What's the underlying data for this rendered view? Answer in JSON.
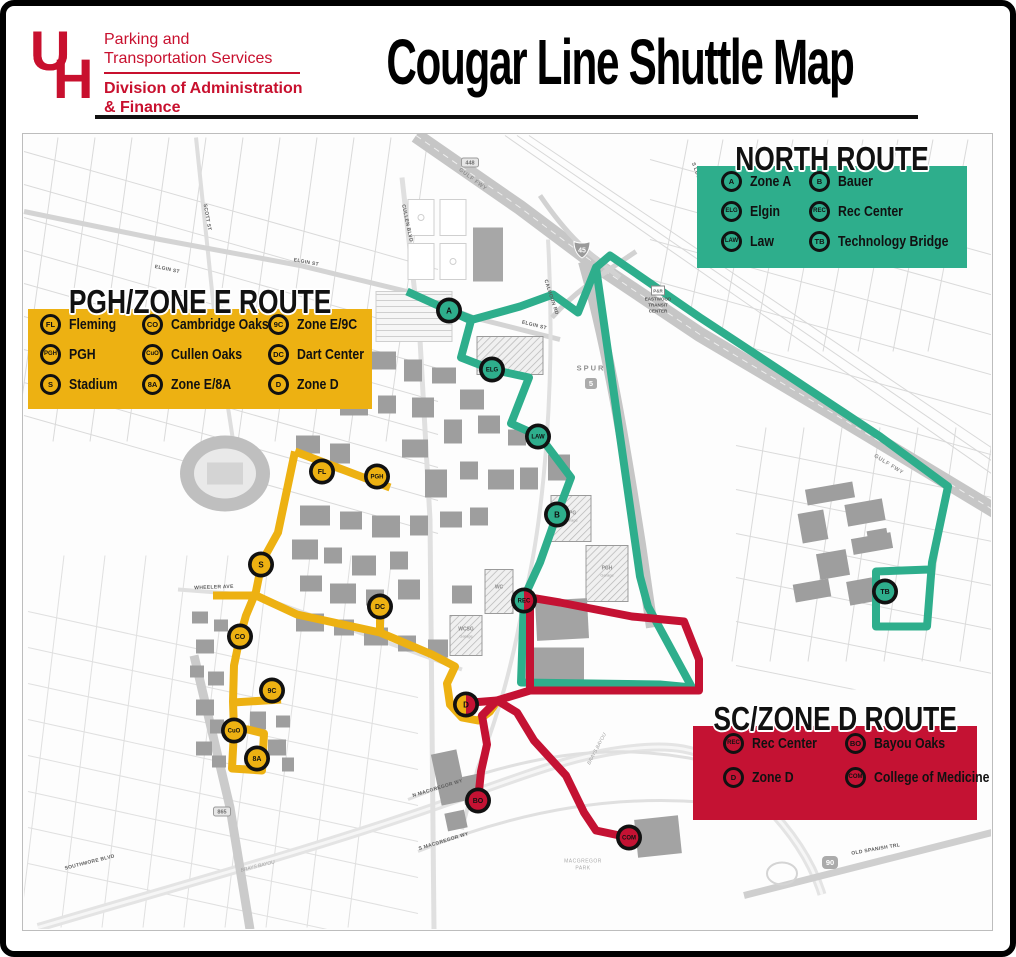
{
  "header": {
    "logo": "UH",
    "dept_line1": "Parking and",
    "dept_line2": "Transportation Services",
    "division_line1": "Division of Administration",
    "division_line2": "& Finance",
    "title": "Cougar Line Shuttle Map"
  },
  "colors": {
    "uh_red": "#C8102E",
    "north": "#2EAE8C",
    "pgh": "#EDB112",
    "sc": "#C41233",
    "badge_ring": "#111111"
  },
  "legends": [
    {
      "id": "north",
      "title": "NORTH ROUTE",
      "color": "north",
      "stops": [
        {
          "code": "A",
          "label": "Zone A"
        },
        {
          "code": "ELG",
          "label": "Elgin"
        },
        {
          "code": "LAW",
          "label": "Law"
        },
        {
          "code": "B",
          "label": "Bauer"
        },
        {
          "code": "REC",
          "label": "Rec Center"
        },
        {
          "code": "TB",
          "label": "Technology Bridge"
        }
      ]
    },
    {
      "id": "pgh",
      "title": "PGH/ZONE E ROUTE",
      "color": "pgh",
      "stops": [
        {
          "code": "FL",
          "label": "Fleming"
        },
        {
          "code": "PGH",
          "label": "PGH"
        },
        {
          "code": "S",
          "label": "Stadium"
        },
        {
          "code": "CO",
          "label": "Cambridge Oaks"
        },
        {
          "code": "CuO",
          "label": "Cullen Oaks"
        },
        {
          "code": "8A",
          "label": "Zone E/8A"
        },
        {
          "code": "9C",
          "label": "Zone E/9C"
        },
        {
          "code": "DC",
          "label": "Dart Center"
        },
        {
          "code": "D",
          "label": "Zone D"
        }
      ]
    },
    {
      "id": "sc",
      "title": "SC/ZONE D ROUTE",
      "color": "sc",
      "stops": [
        {
          "code": "REC",
          "label": "Rec Center"
        },
        {
          "code": "D",
          "label": "Zone D"
        },
        {
          "code": "BO",
          "label": "Bayou Oaks"
        },
        {
          "code": "COM",
          "label": "College of Medicine"
        }
      ]
    }
  ],
  "map": {
    "stops": [
      {
        "code": "A",
        "name": "Zone A",
        "x": 449,
        "y": 311,
        "route": "north"
      },
      {
        "code": "ELG",
        "name": "Elgin",
        "x": 492,
        "y": 370,
        "route": "north"
      },
      {
        "code": "LAW",
        "name": "Law",
        "x": 538,
        "y": 437,
        "route": "north"
      },
      {
        "code": "B",
        "name": "Bauer",
        "x": 557,
        "y": 515,
        "route": "north"
      },
      {
        "code": "TB",
        "name": "Technology Bridge",
        "x": 885,
        "y": 592,
        "route": "north"
      },
      {
        "code": "REC",
        "name": "Rec Center",
        "x": 524,
        "y": 601,
        "split": [
          "north",
          "sc"
        ]
      },
      {
        "code": "FL",
        "name": "Fleming",
        "x": 322,
        "y": 472,
        "route": "pgh"
      },
      {
        "code": "PGH",
        "name": "PGH",
        "x": 377,
        "y": 477,
        "route": "pgh"
      },
      {
        "code": "S",
        "name": "Stadium",
        "x": 261,
        "y": 565,
        "route": "pgh"
      },
      {
        "code": "DC",
        "name": "Dart Center",
        "x": 380,
        "y": 607,
        "route": "pgh"
      },
      {
        "code": "CO",
        "name": "Cambridge Oaks",
        "x": 240,
        "y": 637,
        "route": "pgh"
      },
      {
        "code": "9C",
        "name": "Zone E/9C",
        "x": 272,
        "y": 691,
        "route": "pgh"
      },
      {
        "code": "CuO",
        "name": "Cullen Oaks",
        "x": 234,
        "y": 731,
        "route": "pgh"
      },
      {
        "code": "8A",
        "name": "Zone E/8A",
        "x": 257,
        "y": 759,
        "route": "pgh"
      },
      {
        "code": "D",
        "name": "Zone D",
        "x": 466,
        "y": 705,
        "split": [
          "pgh",
          "sc"
        ]
      },
      {
        "code": "BO",
        "name": "Bayou Oaks",
        "x": 478,
        "y": 801,
        "route": "sc"
      },
      {
        "code": "COM",
        "name": "College of Medicine",
        "x": 629,
        "y": 838,
        "route": "sc"
      }
    ],
    "labels": [
      {
        "t": "GULF FWY",
        "x": 472,
        "y": 181,
        "r": 37,
        "k": "fwy"
      },
      {
        "t": "GULF FWY",
        "x": 888,
        "y": 466,
        "r": 32,
        "k": "fwy"
      },
      {
        "t": "ELGIN ST",
        "x": 167,
        "y": 271,
        "r": 12,
        "k": "street"
      },
      {
        "t": "ELGIN ST",
        "x": 306,
        "y": 264,
        "r": 11,
        "k": "street"
      },
      {
        "t": "ELGIN ST",
        "x": 534,
        "y": 327,
        "r": 14,
        "k": "street"
      },
      {
        "t": "CULLEN BLVD",
        "x": 406,
        "y": 224,
        "r": 78,
        "k": "street"
      },
      {
        "t": "SCOTT ST",
        "x": 206,
        "y": 218,
        "r": 80,
        "k": "street"
      },
      {
        "t": "S LOCKWOOD DR",
        "x": 700,
        "y": 186,
        "r": 70,
        "k": "street"
      },
      {
        "t": "CALHOUN RD",
        "x": 550,
        "y": 298,
        "r": 72,
        "k": "street"
      },
      {
        "t": "WHEELER AVE",
        "x": 214,
        "y": 589,
        "r": -2,
        "k": "street"
      },
      {
        "t": "SOUTHMORE BLVD",
        "x": 90,
        "y": 864,
        "r": -14,
        "k": "street"
      },
      {
        "t": "N MACGREGOR WY",
        "x": 438,
        "y": 790,
        "r": -17,
        "k": "street"
      },
      {
        "t": "S MACGREGOR WY",
        "x": 444,
        "y": 843,
        "r": -17,
        "k": "street"
      },
      {
        "t": "OLD SPANISH TRL",
        "x": 876,
        "y": 851,
        "r": -10,
        "k": "street"
      },
      {
        "t": "BRAYS BAYOU",
        "x": 258,
        "y": 868,
        "r": -14,
        "k": "water"
      },
      {
        "t": "BRAYS BAYOU",
        "x": 598,
        "y": 750,
        "r": -62,
        "k": "water"
      },
      {
        "t": "MACGREGOR",
        "x": 583,
        "y": 863,
        "r": 0,
        "k": "park"
      },
      {
        "t": "PARK",
        "x": 583,
        "y": 870,
        "r": 0,
        "k": "park"
      },
      {
        "t": "EASTWOOD",
        "x": 658,
        "y": 301,
        "r": 0,
        "k": "poi"
      },
      {
        "t": "TRANSIT",
        "x": 658,
        "y": 307,
        "r": 0,
        "k": "poi"
      },
      {
        "t": "CENTER",
        "x": 658,
        "y": 313,
        "r": 0,
        "k": "poi"
      },
      {
        "t": "SPUR",
        "x": 591,
        "y": 371,
        "r": 0,
        "k": "fwy2"
      },
      {
        "t": "EPG",
        "x": 571,
        "y": 515,
        "r": 0,
        "k": "gar"
      },
      {
        "t": "Garage",
        "x": 571,
        "y": 522,
        "r": 0,
        "k": "gar2"
      },
      {
        "t": "PGH",
        "x": 607,
        "y": 570,
        "r": 0,
        "k": "gar"
      },
      {
        "t": "Garage",
        "x": 607,
        "y": 577,
        "r": 0,
        "k": "gar2"
      },
      {
        "t": "WC",
        "x": 499,
        "y": 589,
        "r": 0,
        "k": "gar"
      },
      {
        "t": "WCSG",
        "x": 466,
        "y": 631,
        "r": 0,
        "k": "gar"
      },
      {
        "t": "Garage",
        "x": 466,
        "y": 638,
        "r": 0,
        "k": "gar2"
      }
    ],
    "shields": [
      {
        "kind": "interstate",
        "t": "45",
        "x": 582,
        "y": 249
      },
      {
        "kind": "us",
        "t": "90",
        "x": 830,
        "y": 863
      },
      {
        "kind": "spur",
        "t": "5",
        "x": 591,
        "y": 384
      },
      {
        "kind": "marker",
        "t": "448",
        "x": 470,
        "y": 163
      },
      {
        "kind": "marker",
        "t": "865",
        "x": 222,
        "y": 812
      },
      {
        "kind": "pr",
        "t": "P&R",
        "x": 658,
        "y": 291
      }
    ]
  }
}
